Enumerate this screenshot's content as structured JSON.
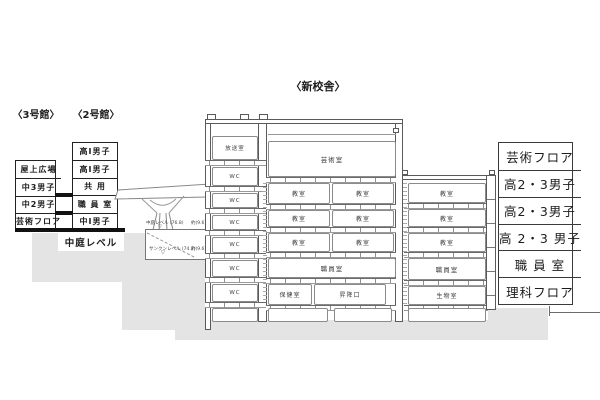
{
  "colors": {
    "ground": "#e4e4e4",
    "line": "#3f3f3f"
  },
  "titles": {
    "main": "〈新校舎〉",
    "building3": "〈3号館〉",
    "building2": "〈2号館〉"
  },
  "building3": {
    "rows": [
      "屋上広場",
      "中3男子",
      "中2男子",
      "芸術フロア"
    ]
  },
  "building2": {
    "rows": [
      "高Ⅰ男子",
      "高Ⅰ男子",
      "共 用",
      "職 員 室",
      "中Ⅰ男子"
    ]
  },
  "courtyard_label": "中庭レベル",
  "pit": {
    "upper_label": "中庭レベル (76.8)",
    "upper_side": "約(9.6)",
    "lower_label": "サンクンレベル (74.2)",
    "lower_side": "約(9.6)",
    "marker": "▽"
  },
  "tower": {
    "rooms": [
      "放送室",
      "WC",
      "WC",
      "WC",
      "WC",
      "WC",
      "WC"
    ]
  },
  "central": {
    "art_room": "芸術室",
    "floor1": [
      "教室",
      "教室"
    ],
    "floor2": [
      "教室",
      "教室"
    ],
    "floor3": [
      "教室",
      "教室"
    ],
    "staff_room": "職員室",
    "entrance_floor": [
      "保健室",
      "昇降口"
    ]
  },
  "right_block": {
    "rooms": [
      "教室",
      "教室",
      "教室",
      "職員室",
      "生物室"
    ]
  },
  "right_labels": {
    "rows": [
      "芸術フロア",
      "高2・3男子",
      "高2・3男子",
      "高 2・3 男子",
      "職 員 室",
      "理科フロア"
    ]
  }
}
